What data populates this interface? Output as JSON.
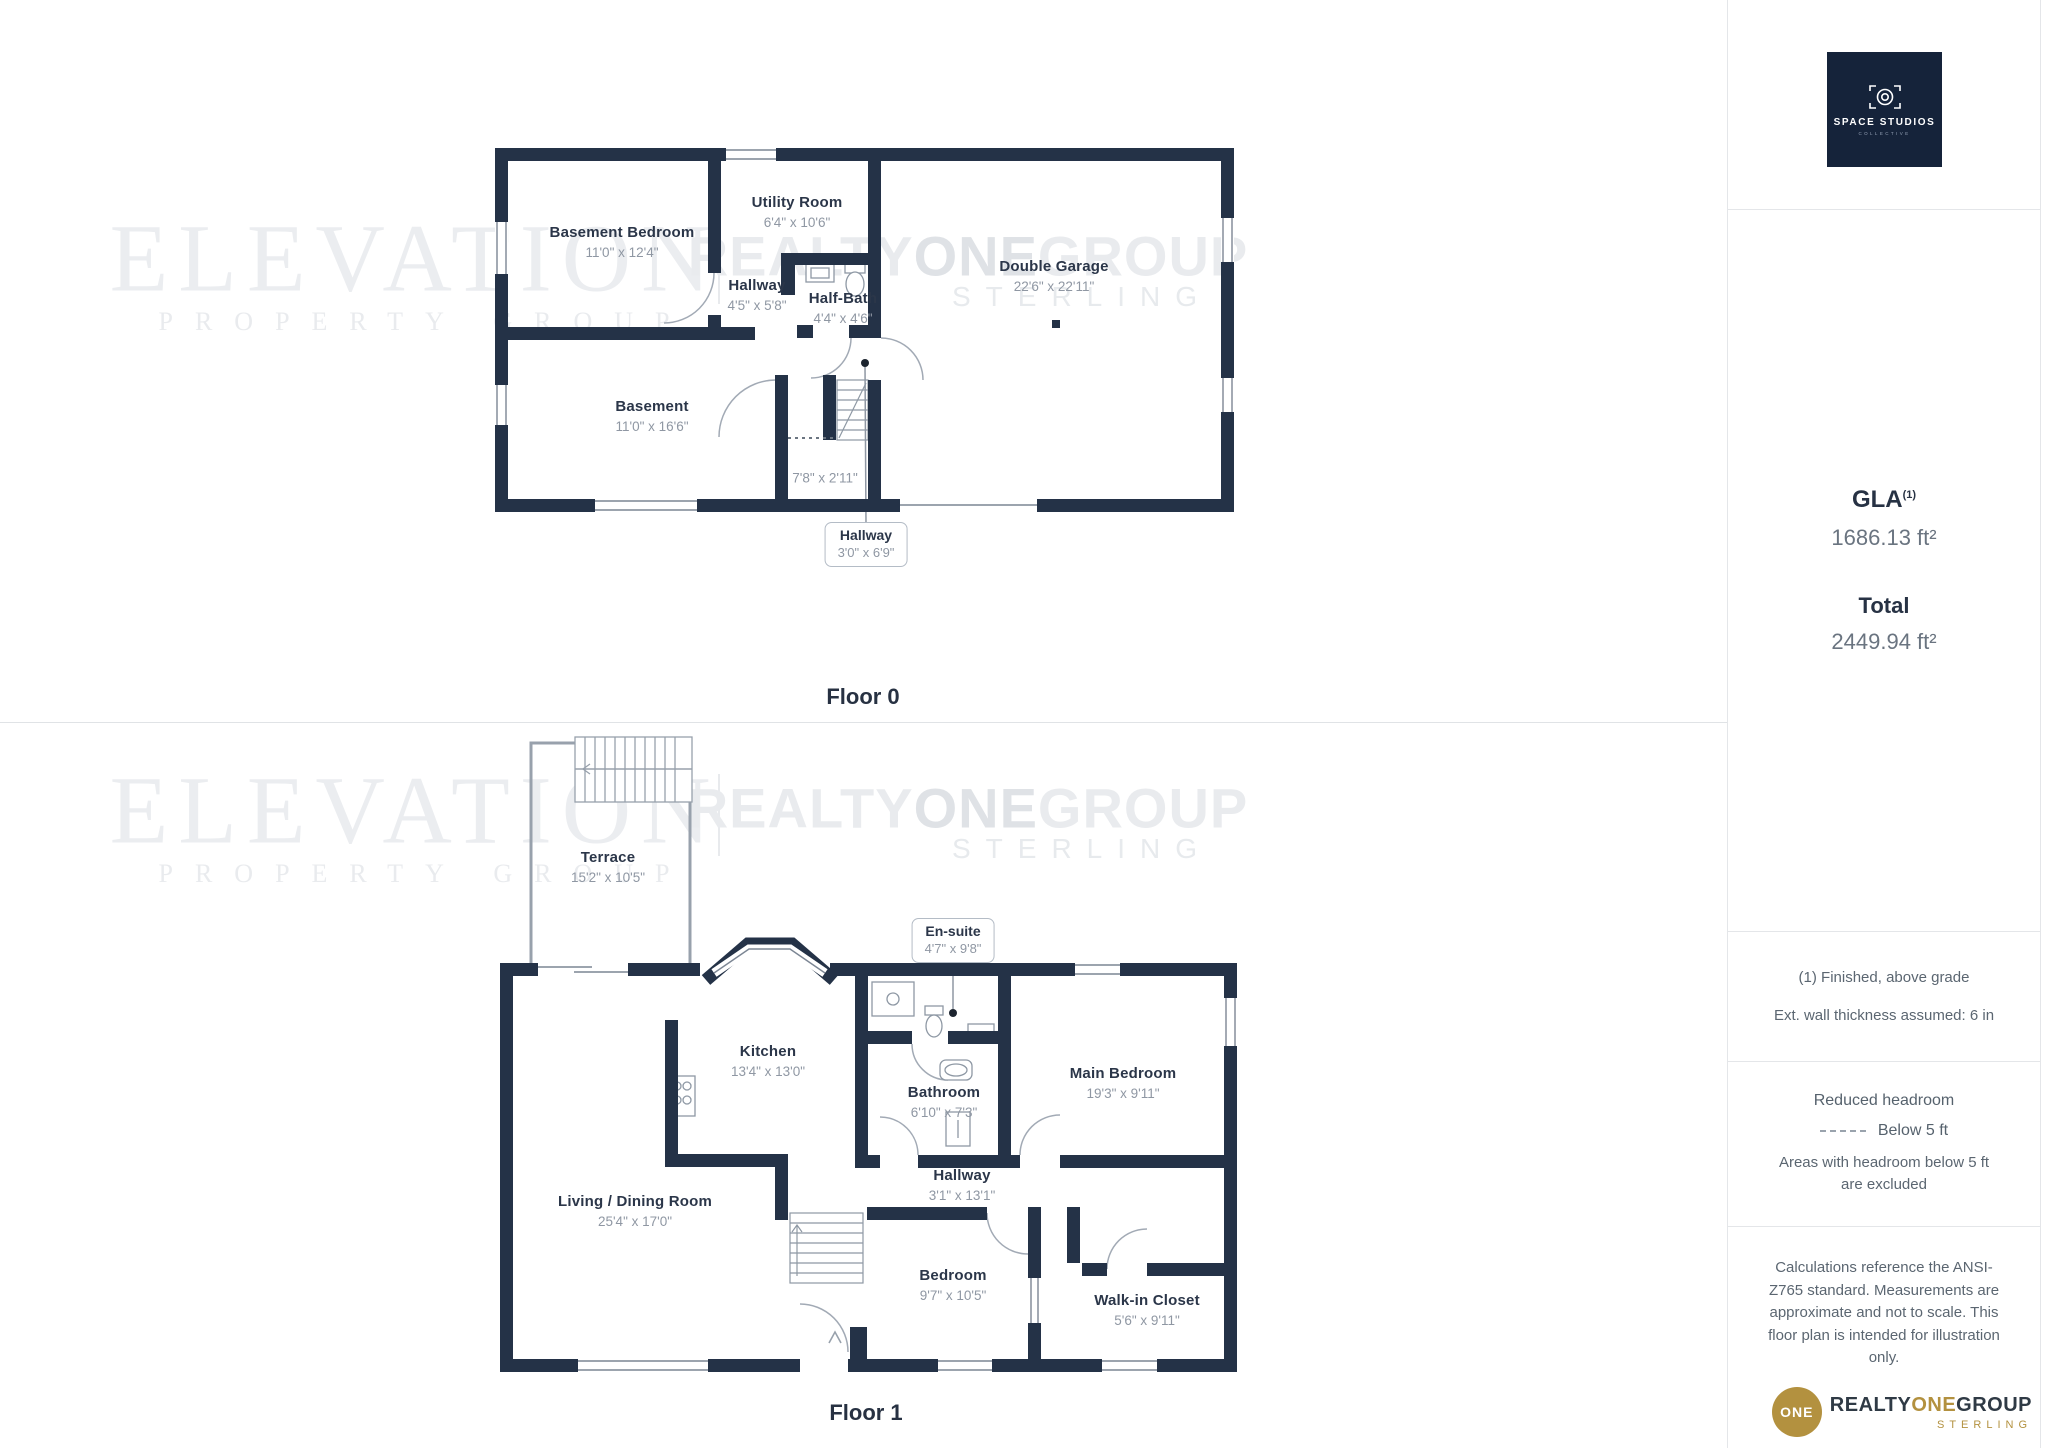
{
  "floors": [
    {
      "title": "Floor 0",
      "rooms": {
        "basement_bedroom": {
          "name": "Basement Bedroom",
          "dims": "11'0\" x 12'4\""
        },
        "utility_room": {
          "name": "Utility Room",
          "dims": "6'4\" x 10'6\""
        },
        "hallway": {
          "name": "Hallway",
          "dims": "4'5\" x 5'8\""
        },
        "half_bath": {
          "name": "Half-Bath",
          "dims": "4'4\" x 4'6\""
        },
        "double_garage": {
          "name": "Double Garage",
          "dims": "22'6\" x 22'11\""
        },
        "basement": {
          "name": "Basement",
          "dims": "11'0\" x 16'6\""
        }
      },
      "extra_dim": "7'8\" x 2'11\"",
      "callout": {
        "name": "Hallway",
        "dims": "3'0\" x 6'9\""
      }
    },
    {
      "title": "Floor 1",
      "rooms": {
        "terrace": {
          "name": "Terrace",
          "dims": "15'2\" x 10'5\""
        },
        "kitchen": {
          "name": "Kitchen",
          "dims": "13'4\" x 13'0\""
        },
        "bathroom": {
          "name": "Bathroom",
          "dims": "6'10\" x 7'3\""
        },
        "main_bedroom": {
          "name": "Main Bedroom",
          "dims": "19'3\" x 9'11\""
        },
        "living_dining": {
          "name": "Living / Dining Room",
          "dims": "25'4\" x 17'0\""
        },
        "hallway": {
          "name": "Hallway",
          "dims": "3'1\" x 13'1\""
        },
        "bedroom": {
          "name": "Bedroom",
          "dims": "9'7\" x 10'5\""
        },
        "walk_in_closet": {
          "name": "Walk-in Closet",
          "dims": "5'6\" x 9'11\""
        }
      },
      "callout": {
        "name": "En-suite",
        "dims": "4'7\" x 9'8\""
      }
    }
  ],
  "watermark": {
    "brand": "ELEVATION",
    "brand_sub": "PROPERTY GROUP",
    "realty": "REALTY",
    "one": "ONE",
    "group": "GROUP",
    "sterling": "STERLING"
  },
  "sidebar": {
    "studio_logo": {
      "name": "SPACE STUDIOS",
      "sub": "COLLECTIVE"
    },
    "gla_label": "GLA",
    "gla_sup": "(1)",
    "gla_value": "1686.13 ft²",
    "total_label": "Total",
    "total_value": "2449.94 ft²",
    "notes": [
      "(1) Finished, above grade",
      "Ext. wall thickness assumed: 6 in"
    ],
    "headroom": {
      "title": "Reduced headroom",
      "legend": "Below 5 ft",
      "note": "Areas with headroom below 5 ft are excluded"
    },
    "disclaimer": "Calculations reference the ANSI-Z765 standard. Measurements are approximate and not to scale. This floor plan is intended for illustration only.",
    "brand": {
      "circle": "ONE",
      "realty": "REALTY",
      "one": "ONE",
      "group": "GROUP",
      "sub": "STERLING"
    }
  },
  "colors": {
    "wall": "#243247",
    "accent_gold": "#b3913f",
    "logo_navy": "#15233a"
  }
}
